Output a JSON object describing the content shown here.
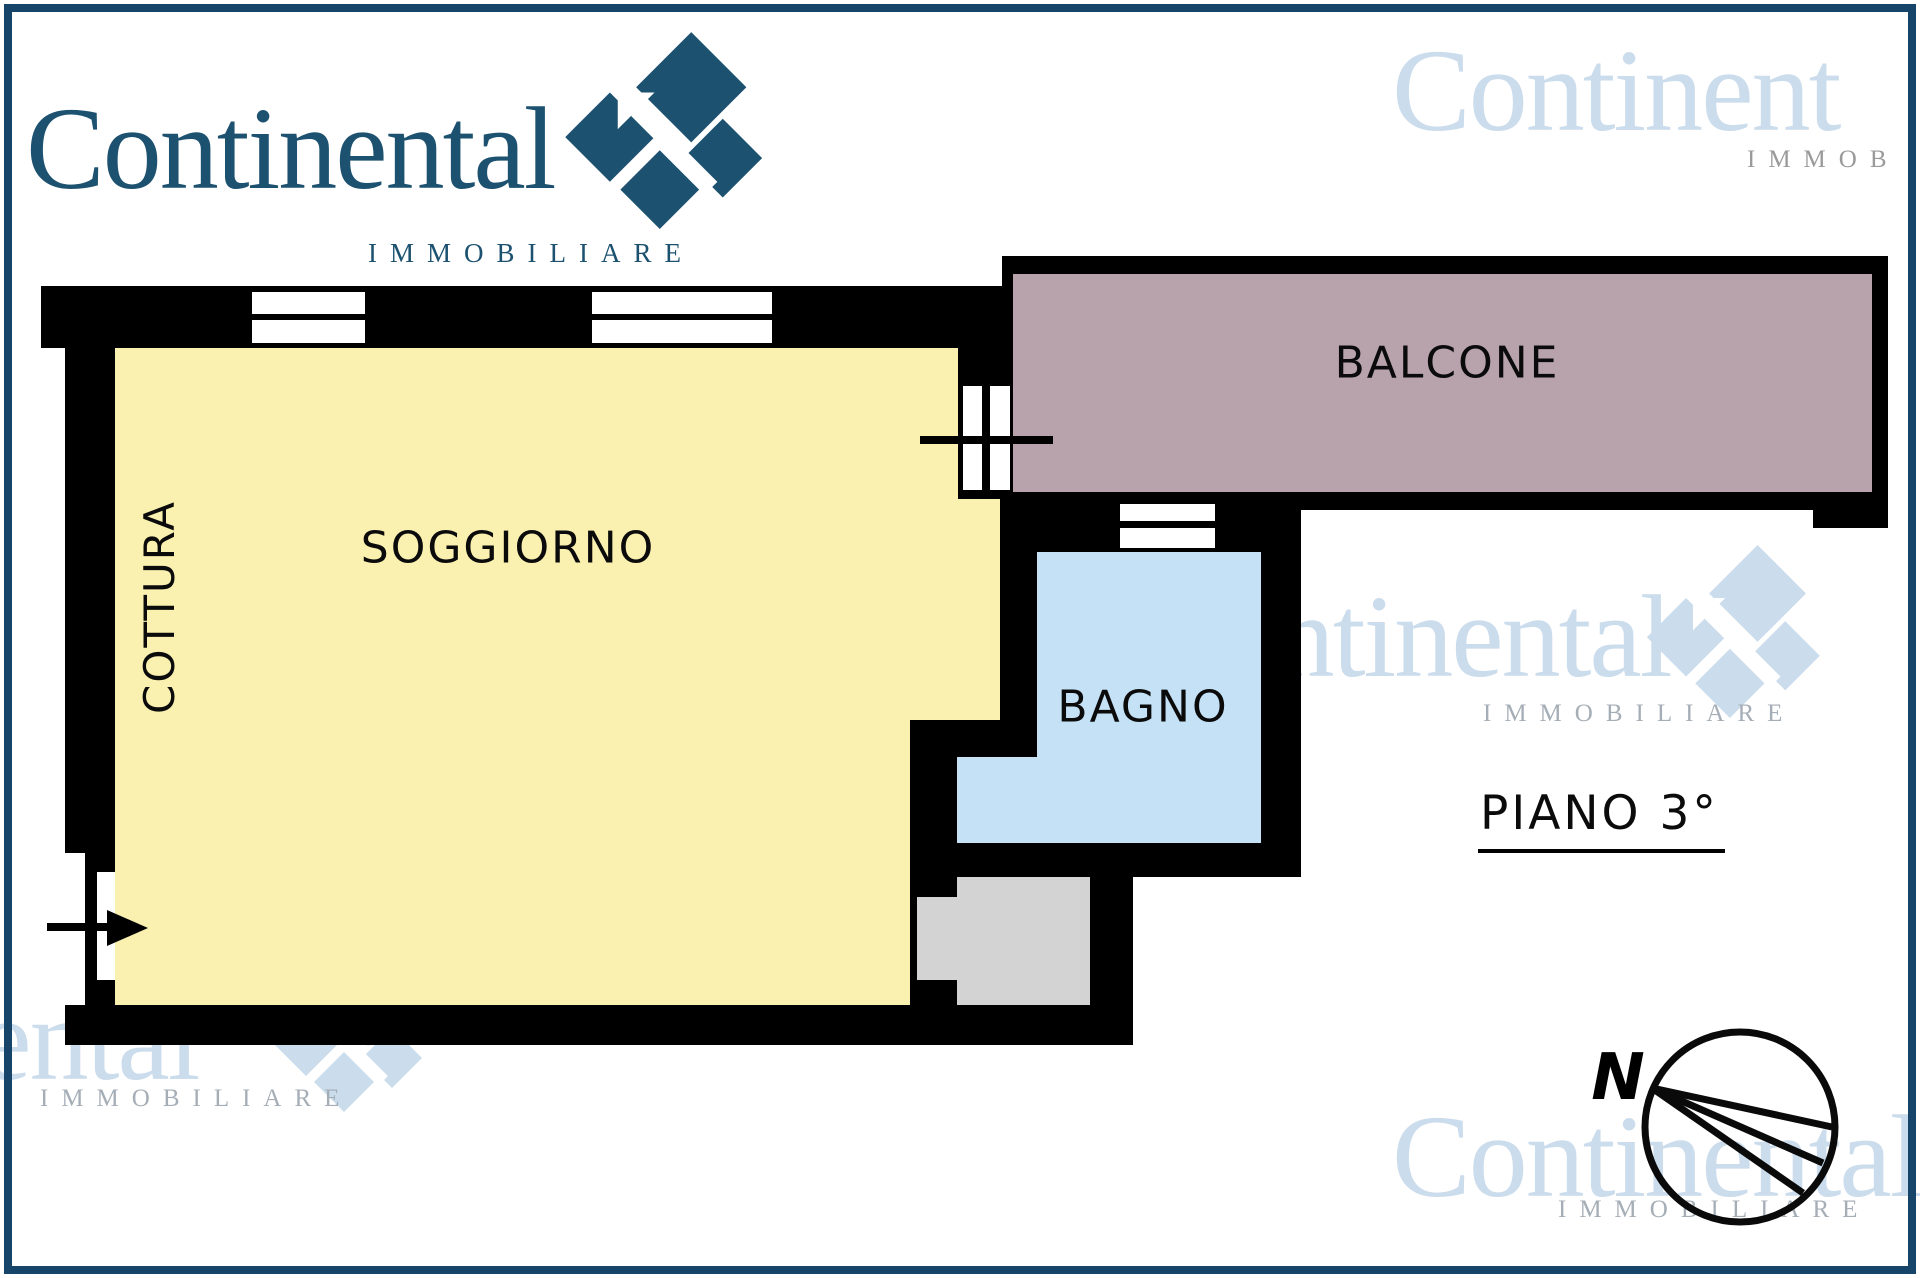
{
  "logo": {
    "brand": "Continental",
    "subtitle": "IMMOBILIARE"
  },
  "watermarks": {
    "top_right": {
      "brand": "Continent",
      "subtitle": "IMMOB"
    },
    "mid_right": {
      "brand": "Continental",
      "subtitle": "IMMOBILIARE"
    },
    "bottom_left": {
      "brand": "Continental",
      "subtitle": "IMMOBILIARE"
    },
    "bottom_right": {
      "brand": "Continental",
      "subtitle": "IMMOBILIARE"
    }
  },
  "plan": {
    "rooms": [
      {
        "id": "soggiorno",
        "label": "SOGGIORNO"
      },
      {
        "id": "cottura",
        "label": "COTTURA"
      },
      {
        "id": "bagno",
        "label": "BAGNO"
      },
      {
        "id": "balcone",
        "label": "BALCONE"
      }
    ],
    "floor_label": "PIANO 3°"
  },
  "compass": {
    "north": "N"
  },
  "colors": {
    "brand": "#1D5170",
    "frame": "#17456A",
    "wall": "#000000",
    "room-yellow": "#FAF0AF",
    "room-blue": "#C4E1F6",
    "room-mauve": "#B8A3AC",
    "room-gray": "#D3D3D3",
    "wm-blue": "#CBDCEC",
    "wm-gray": "#A5AEB6",
    "label": "#0B0B0B"
  }
}
